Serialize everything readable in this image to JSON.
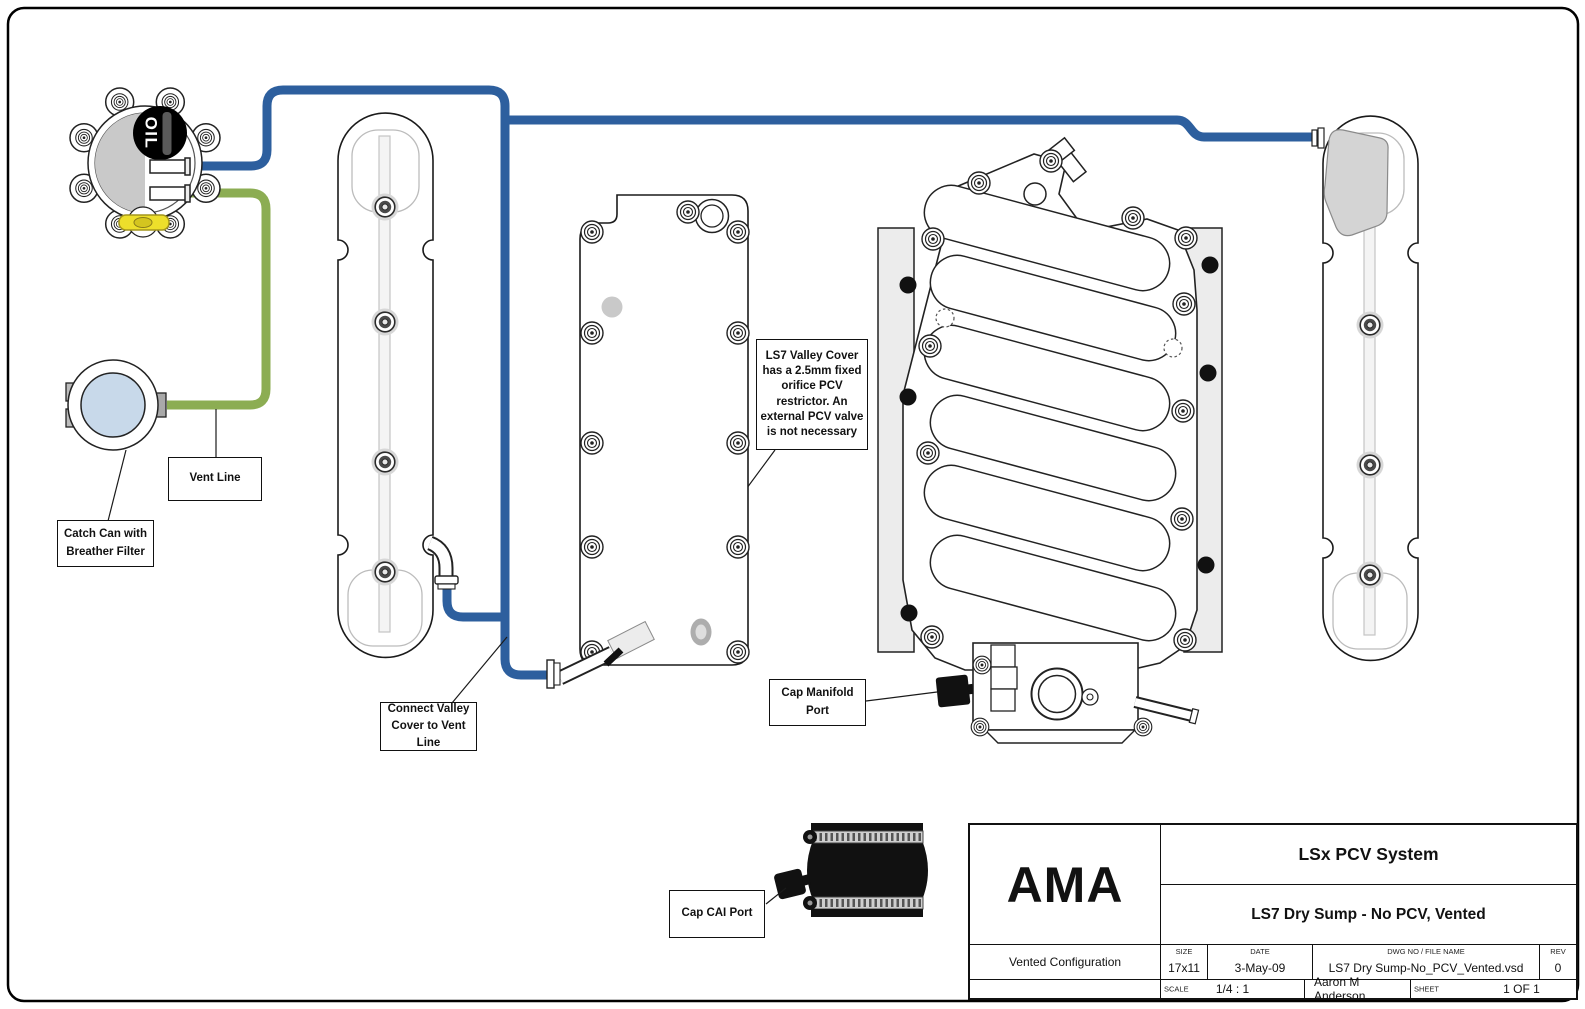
{
  "diagram": {
    "oil_cap_label": "OIL",
    "labels": {
      "vent_line": "Vent Line",
      "catch_can": "Catch Can with Breather Filter",
      "connect_valley": "Connect Valley Cover to Vent Line",
      "valley_note": "LS7 Valley Cover has a 2.5mm fixed orifice PCV restrictor. An external PCV valve is not necessary",
      "cap_manifold": "Cap Manifold Port",
      "cap_cai": "Cap CAI Port"
    },
    "colors": {
      "vent_blue": "#2D5F9E",
      "vent_green": "#8CAD53",
      "catch_can_blue": "#C8D9EA",
      "plug_yellow": "#EDDF2B"
    }
  },
  "title_block": {
    "company": "AMA",
    "title": "LSx PCV System",
    "subtitle": "LS7 Dry Sump - No PCV, Vented",
    "configuration": "Vented Configuration",
    "size_label": "SIZE",
    "size_value": "17x11",
    "date_label": "DATE",
    "date_value": "3-May-09",
    "dwg_label": "DWG NO / FILE NAME",
    "dwg_value": "LS7 Dry Sump-No_PCV_Vented.vsd",
    "rev_label": "REV",
    "rev_value": "0",
    "scale_label": "SCALE",
    "scale_value": "1/4 : 1",
    "author": "Aaron M Anderson",
    "sheet_label": "SHEET",
    "sheet_value": "1 OF 1"
  }
}
